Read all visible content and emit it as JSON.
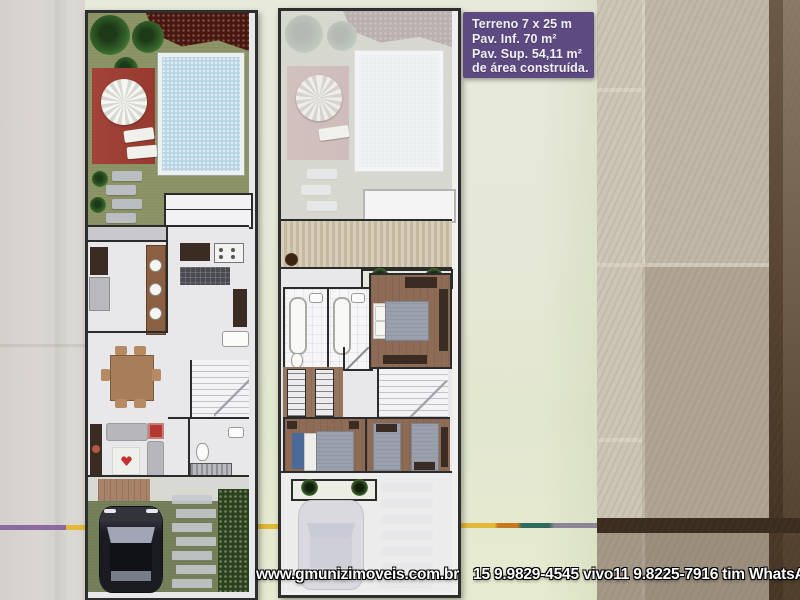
{
  "info_box": {
    "bg_color": "#5c4a80",
    "text_color": "#f3eff7",
    "lines": [
      "Terreno 7 x 25 m",
      "Pav. Inf. 70 m²",
      "Pav. Sup. 54,11 m²",
      "de área construída."
    ]
  },
  "contact": {
    "website": "www.gmunizimoveis.com.br",
    "phones": "15 9.9829-4545 vivo11 9.8225-7916 tim WhatsApp"
  },
  "plans": {
    "left_panel": "ground-floor-plan",
    "right_panel": "upper-floor-plan"
  },
  "palette": {
    "flyer_background": "#e5e8d6",
    "tile_wall_light": "#c0b7a8",
    "tile_wall_dark": "#3a2c1f",
    "grass": "#8d9566",
    "pool_water": "#b9d6e6",
    "deck_red": "#a24438",
    "interior_floor": "#e8e8ea",
    "wood_floor": "#8d6b55",
    "accent_stripe_purple": "#8b6aa2",
    "accent_stripe_yellow": "#e3b93a"
  }
}
